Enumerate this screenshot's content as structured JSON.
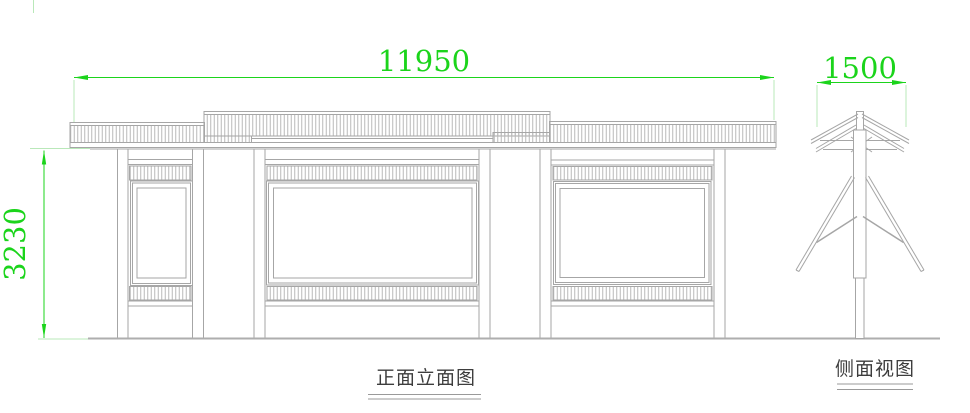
{
  "page": {
    "background": "#ffffff"
  },
  "palette": {
    "line_color": "#a6a6a6",
    "hatch_color": "#b9b9b9",
    "ground_color": "#aeaeae",
    "dimension_color": "#1bd41b",
    "extension_color": "#b9e8b9",
    "label_text_color": "#3d3d3d"
  },
  "front_elevation": {
    "title": "正面立面图",
    "width_dimension": "11950",
    "height_dimension": "3230"
  },
  "side_view": {
    "title": "侧面视图",
    "width_dimension": "1500"
  }
}
